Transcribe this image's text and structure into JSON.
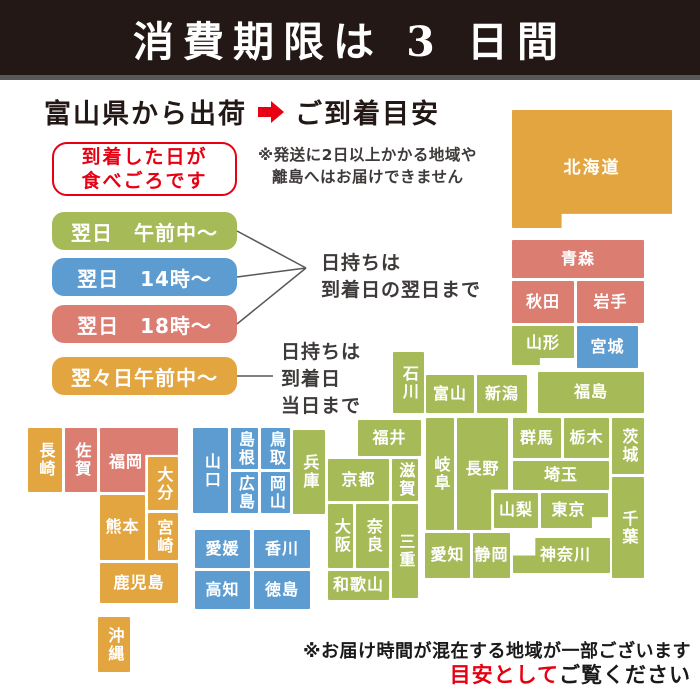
{
  "banner": {
    "title": "消費期限は 3 日間"
  },
  "header": {
    "shipped_from": "富山県から出荷",
    "arrival": "ご到着目安"
  },
  "eat_note": {
    "lines": [
      "到着した日が",
      "食べごろです"
    ]
  },
  "ship_restriction_note": {
    "lines": [
      "※発送に2日以上かかる地域や",
      "離島へはお届けできません"
    ]
  },
  "legend": {
    "pills": [
      {
        "name": "next-day-morning",
        "label": "翌日　午前中〜",
        "color": "green"
      },
      {
        "name": "next-day-14",
        "label": "翌日　14時〜",
        "color": "blue"
      },
      {
        "name": "next-day-18",
        "label": "翌日　18時〜",
        "color": "pink"
      },
      {
        "name": "two-days-later-morning",
        "label": "翌々日午前中〜",
        "color": "orange"
      }
    ],
    "keep_note_next_day": {
      "lines": [
        "日持ちは",
        "到着日の翌日まで"
      ]
    },
    "keep_note_same_day": {
      "lines": [
        "日持ちは",
        "到着日",
        "当日まで"
      ]
    }
  },
  "footer": {
    "note": "※お届け時間が混在する地域が一部ございます",
    "emphasis_red": "目安として",
    "emphasis_black": "ご覧ください"
  },
  "map": {
    "palette": {
      "green": "#a6ba58",
      "blue": "#5c9cd1",
      "pink": "#dc7d72",
      "orange": "#e3a53f",
      "accent_red": "#e60012",
      "banner_bg": "#231815"
    },
    "blocks": [
      {
        "name": "hokkaido",
        "label": "北海道",
        "color": "orange",
        "x": 512,
        "y": 110,
        "w": 160,
        "h": 118,
        "shape": "hokkaido"
      },
      {
        "name": "aomori",
        "label": "青森",
        "color": "pink",
        "x": 512,
        "y": 240,
        "w": 132,
        "h": 38
      },
      {
        "name": "akita",
        "label": "秋田",
        "color": "pink",
        "x": 512,
        "y": 281,
        "w": 62,
        "h": 42
      },
      {
        "name": "iwate",
        "label": "岩手",
        "color": "pink",
        "x": 577,
        "y": 281,
        "w": 67,
        "h": 42
      },
      {
        "name": "yamagata",
        "label": "山形",
        "color": "green",
        "x": 512,
        "y": 326,
        "w": 62,
        "h": 39,
        "shape": "yamagata"
      },
      {
        "name": "miyagi",
        "label": "宮城",
        "color": "blue",
        "x": 577,
        "y": 326,
        "w": 61,
        "h": 42
      },
      {
        "name": "ishikawa",
        "label": "石川",
        "color": "green",
        "x": 393,
        "y": 352,
        "w": 31,
        "h": 61,
        "vertical": true
      },
      {
        "name": "toyama",
        "label": "富山",
        "color": "green",
        "x": 426,
        "y": 375,
        "w": 48,
        "h": 38
      },
      {
        "name": "niigata",
        "label": "新潟",
        "color": "green",
        "x": 477,
        "y": 375,
        "w": 50,
        "h": 38
      },
      {
        "name": "fukushima",
        "label": "福島",
        "color": "green",
        "x": 538,
        "y": 372,
        "w": 106,
        "h": 41
      },
      {
        "name": "fukui",
        "label": "福井",
        "color": "green",
        "x": 358,
        "y": 420,
        "w": 63,
        "h": 36
      },
      {
        "name": "gifu",
        "label": "岐阜",
        "color": "green",
        "x": 426,
        "y": 418,
        "w": 28,
        "h": 112,
        "vertical": true
      },
      {
        "name": "nagano",
        "label": "長野",
        "color": "green",
        "x": 457,
        "y": 418,
        "w": 51,
        "h": 112,
        "shape": "nagano"
      },
      {
        "name": "gunma",
        "label": "群馬",
        "color": "green",
        "x": 513,
        "y": 418,
        "w": 48,
        "h": 40
      },
      {
        "name": "tochigi",
        "label": "栃木",
        "color": "green",
        "x": 564,
        "y": 418,
        "w": 45,
        "h": 40
      },
      {
        "name": "ibaraki",
        "label": "茨城",
        "color": "green",
        "x": 612,
        "y": 418,
        "w": 32,
        "h": 56,
        "vertical": true
      },
      {
        "name": "saitama",
        "label": "埼玉",
        "color": "green",
        "x": 513,
        "y": 461,
        "w": 96,
        "h": 29
      },
      {
        "name": "yamanashi",
        "label": "山梨",
        "color": "green",
        "x": 494,
        "y": 493,
        "w": 44,
        "h": 35
      },
      {
        "name": "tokyo",
        "label": "東京",
        "color": "green",
        "x": 541,
        "y": 493,
        "w": 67,
        "h": 35,
        "shape": "tokyo"
      },
      {
        "name": "chiba",
        "label": "千葉",
        "color": "green",
        "x": 612,
        "y": 477,
        "w": 32,
        "h": 101,
        "vertical": true
      },
      {
        "name": "kanagawa",
        "label": "神奈川",
        "color": "green",
        "x": 513,
        "y": 538,
        "w": 97,
        "h": 35,
        "shape": "kanagawa"
      },
      {
        "name": "shizuoka",
        "label": "静岡",
        "color": "green",
        "x": 473,
        "y": 533,
        "w": 37,
        "h": 45
      },
      {
        "name": "aichi",
        "label": "愛知",
        "color": "green",
        "x": 425,
        "y": 533,
        "w": 45,
        "h": 45
      },
      {
        "name": "shiga",
        "label": "滋賀",
        "color": "green",
        "x": 392,
        "y": 459,
        "w": 26,
        "h": 42,
        "vertical": true
      },
      {
        "name": "kyoto",
        "label": "京都",
        "color": "green",
        "x": 328,
        "y": 459,
        "w": 61,
        "h": 42
      },
      {
        "name": "osaka",
        "label": "大阪",
        "color": "green",
        "x": 328,
        "y": 504,
        "w": 25,
        "h": 64,
        "vertical": true
      },
      {
        "name": "nara",
        "label": "奈良",
        "color": "green",
        "x": 356,
        "y": 504,
        "w": 33,
        "h": 64,
        "vertical": true
      },
      {
        "name": "mie",
        "label": "三重",
        "color": "green",
        "x": 392,
        "y": 504,
        "w": 26,
        "h": 94,
        "vertical": true
      },
      {
        "name": "wakayama",
        "label": "和歌山",
        "color": "green",
        "x": 328,
        "y": 571,
        "w": 61,
        "h": 29
      },
      {
        "name": "hyogo",
        "label": "兵庫",
        "color": "green",
        "x": 293,
        "y": 430,
        "w": 32,
        "h": 84,
        "vertical": true
      },
      {
        "name": "tottori",
        "label": "鳥取",
        "color": "blue",
        "x": 261,
        "y": 428,
        "w": 29,
        "h": 41,
        "vertical": true
      },
      {
        "name": "okayama",
        "label": "岡山",
        "color": "blue",
        "x": 261,
        "y": 472,
        "w": 29,
        "h": 41,
        "vertical": true
      },
      {
        "name": "shimane",
        "label": "島根",
        "color": "blue",
        "x": 231,
        "y": 428,
        "w": 27,
        "h": 41,
        "vertical": true
      },
      {
        "name": "hiroshima",
        "label": "広島",
        "color": "blue",
        "x": 231,
        "y": 472,
        "w": 27,
        "h": 41,
        "vertical": true
      },
      {
        "name": "yamaguchi",
        "label": "山口",
        "color": "blue",
        "x": 193,
        "y": 428,
        "w": 35,
        "h": 85,
        "vertical": true
      },
      {
        "name": "ehime",
        "label": "愛媛",
        "color": "blue",
        "x": 195,
        "y": 530,
        "w": 55,
        "h": 38
      },
      {
        "name": "kagawa",
        "label": "香川",
        "color": "blue",
        "x": 254,
        "y": 530,
        "w": 56,
        "h": 38
      },
      {
        "name": "kochi",
        "label": "高知",
        "color": "blue",
        "x": 195,
        "y": 571,
        "w": 55,
        "h": 38
      },
      {
        "name": "tokushima",
        "label": "徳島",
        "color": "blue",
        "x": 254,
        "y": 571,
        "w": 56,
        "h": 38
      },
      {
        "name": "fukuoka",
        "label": "福岡",
        "color": "pink",
        "x": 100,
        "y": 428,
        "w": 78,
        "h": 64,
        "shape": "fukuoka"
      },
      {
        "name": "saga",
        "label": "佐賀",
        "color": "pink",
        "x": 65,
        "y": 428,
        "w": 32,
        "h": 64,
        "vertical": true
      },
      {
        "name": "nagasaki",
        "label": "長崎",
        "color": "orange",
        "x": 28,
        "y": 428,
        "w": 34,
        "h": 64,
        "vertical": true
      },
      {
        "name": "oita",
        "label": "大分",
        "color": "orange",
        "x": 148,
        "y": 457,
        "w": 30,
        "h": 53,
        "vertical": true
      },
      {
        "name": "kumamoto",
        "label": "熊本",
        "color": "orange",
        "x": 100,
        "y": 495,
        "w": 45,
        "h": 65
      },
      {
        "name": "miyazaki",
        "label": "宮崎",
        "color": "orange",
        "x": 148,
        "y": 513,
        "w": 30,
        "h": 47,
        "vertical": true
      },
      {
        "name": "kagoshima",
        "label": "鹿児島",
        "color": "orange",
        "x": 100,
        "y": 563,
        "w": 78,
        "h": 40
      },
      {
        "name": "okinawa",
        "label": "沖縄",
        "color": "orange",
        "x": 98,
        "y": 617,
        "w": 32,
        "h": 55,
        "vertical": true
      }
    ]
  }
}
